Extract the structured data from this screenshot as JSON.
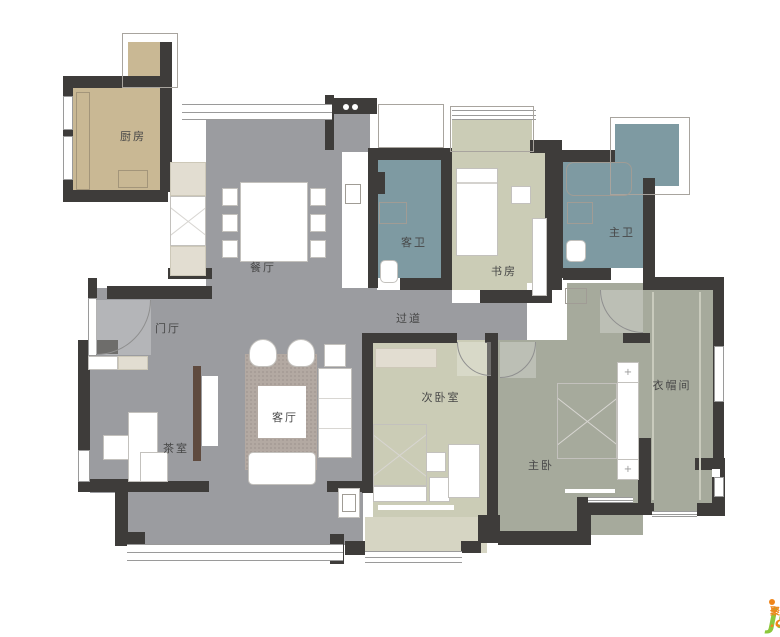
{
  "palette": {
    "wall": "#3e3c3a",
    "floor_gray": "#9b9ca0",
    "kitchen_tan": "#c9b894",
    "bath_teal": "#7e9aa2",
    "bedroom_sage": "#cbccb6",
    "master_green": "#a6aa9c",
    "balcony_sage": "#d6d5c3",
    "label": "#474747",
    "watermark_green": "#8cc83c",
    "watermark_orange": "#f08519"
  },
  "rooms": [
    {
      "id": "kitchen",
      "label": "厨房",
      "x": 133,
      "y": 136
    },
    {
      "id": "dining-room",
      "label": "餐厅",
      "x": 263,
      "y": 267
    },
    {
      "id": "guest-bathroom",
      "label": "客卫",
      "x": 414,
      "y": 242
    },
    {
      "id": "study",
      "label": "书房",
      "x": 504,
      "y": 271
    },
    {
      "id": "master-bathroom",
      "label": "主卫",
      "x": 622,
      "y": 232
    },
    {
      "id": "hallway",
      "label": "过道",
      "x": 409,
      "y": 318
    },
    {
      "id": "entrance-hall",
      "label": "门厅",
      "x": 168,
      "y": 328
    },
    {
      "id": "living-room",
      "label": "客厅",
      "x": 285,
      "y": 417
    },
    {
      "id": "tea-room",
      "label": "茶室",
      "x": 176,
      "y": 448
    },
    {
      "id": "second-bedroom",
      "label": "次卧室",
      "x": 441,
      "y": 397
    },
    {
      "id": "master-bedroom",
      "label": "主卧",
      "x": 541,
      "y": 465
    },
    {
      "id": "walk-in-closet",
      "label": "衣帽间",
      "x": 672,
      "y": 385
    }
  ],
  "floors": [
    {
      "name": "kitchen-floor",
      "x": 72,
      "y": 86,
      "w": 88,
      "h": 106,
      "color": "kitchen_tan"
    },
    {
      "name": "kitchen-neck-floor",
      "x": 128,
      "y": 42,
      "w": 34,
      "h": 46,
      "color": "kitchen_tan"
    },
    {
      "name": "dining-floor",
      "x": 206,
      "y": 112,
      "w": 136,
      "h": 176,
      "color": "floor_gray"
    },
    {
      "name": "hallway-floor",
      "x": 96,
      "y": 288,
      "w": 431,
      "h": 52,
      "color": "floor_gray"
    },
    {
      "name": "living-tea-floor",
      "x": 90,
      "y": 288,
      "w": 273,
      "h": 205,
      "color": "floor_gray"
    },
    {
      "name": "living-balcony-floor",
      "x": 127,
      "y": 493,
      "w": 236,
      "h": 52,
      "color": "floor_gray"
    },
    {
      "name": "heater-alcove-floor",
      "x": 334,
      "y": 112,
      "w": 36,
      "h": 42,
      "color": "floor_gray"
    },
    {
      "name": "guest-bath-floor",
      "x": 377,
      "y": 160,
      "w": 64,
      "h": 126,
      "color": "bath_teal"
    },
    {
      "name": "study-bay-floor",
      "x": 452,
      "y": 120,
      "w": 80,
      "h": 34,
      "color": "bedroom_sage"
    },
    {
      "name": "study-floor",
      "x": 452,
      "y": 152,
      "w": 93,
      "h": 150,
      "color": "bedroom_sage"
    },
    {
      "name": "master-bath-floor",
      "x": 563,
      "y": 162,
      "w": 80,
      "h": 106,
      "color": "bath_teal"
    },
    {
      "name": "master-bath-balcony",
      "x": 615,
      "y": 124,
      "w": 64,
      "h": 62,
      "color": "bath_teal"
    },
    {
      "name": "suite-entry-floor",
      "x": 567,
      "y": 283,
      "w": 76,
      "h": 57,
      "color": "master_green"
    },
    {
      "name": "master-bedroom-floor",
      "x": 498,
      "y": 340,
      "w": 145,
      "h": 195,
      "color": "master_green"
    },
    {
      "name": "closet-floor",
      "x": 643,
      "y": 290,
      "w": 70,
      "h": 223,
      "color": "master_green"
    },
    {
      "name": "second-bedroom-floor",
      "x": 373,
      "y": 340,
      "w": 114,
      "h": 177,
      "color": "bedroom_sage"
    },
    {
      "name": "second-balcony-floor",
      "x": 365,
      "y": 517,
      "w": 122,
      "h": 36,
      "color": "balcony_sage"
    }
  ],
  "white_patches": [
    [
      342,
      152,
      26,
      133
    ],
    [
      527,
      283,
      40,
      57
    ],
    [
      452,
      290,
      28,
      13
    ],
    [
      377,
      278,
      23,
      12
    ],
    [
      611,
      268,
      32,
      12
    ]
  ],
  "walls": [
    [
      63,
      76,
      100,
      12
    ],
    [
      63,
      88,
      10,
      104
    ],
    [
      63,
      190,
      105,
      12
    ],
    [
      160,
      42,
      12,
      150
    ],
    [
      107,
      286,
      105,
      13
    ],
    [
      88,
      278,
      9,
      22
    ],
    [
      78,
      340,
      40,
      14
    ],
    [
      78,
      340,
      12,
      152
    ],
    [
      78,
      479,
      50,
      13
    ],
    [
      115,
      487,
      13,
      52
    ],
    [
      115,
      532,
      30,
      14
    ],
    [
      127,
      481,
      82,
      11
    ],
    [
      327,
      481,
      37,
      11
    ],
    [
      330,
      534,
      14,
      30
    ],
    [
      362,
      333,
      11,
      160
    ],
    [
      345,
      541,
      20,
      14
    ],
    [
      478,
      515,
      22,
      28
    ],
    [
      461,
      541,
      20,
      12
    ],
    [
      325,
      95,
      9,
      55
    ],
    [
      331,
      98,
      46,
      16
    ],
    [
      368,
      148,
      80,
      12
    ],
    [
      368,
      155,
      10,
      133
    ],
    [
      441,
      148,
      11,
      142
    ],
    [
      400,
      278,
      52,
      12
    ],
    [
      480,
      290,
      72,
      13
    ],
    [
      530,
      140,
      32,
      13
    ],
    [
      545,
      148,
      17,
      142
    ],
    [
      553,
      150,
      62,
      12
    ],
    [
      553,
      152,
      10,
      126
    ],
    [
      563,
      268,
      48,
      12
    ],
    [
      643,
      178,
      12,
      104
    ],
    [
      643,
      277,
      81,
      13
    ],
    [
      713,
      283,
      11,
      175
    ],
    [
      695,
      458,
      30,
      12
    ],
    [
      712,
      470,
      13,
      40
    ],
    [
      697,
      503,
      28,
      13
    ],
    [
      638,
      438,
      13,
      75
    ],
    [
      623,
      333,
      27,
      10
    ],
    [
      362,
      333,
      95,
      10
    ],
    [
      485,
      333,
      13,
      10
    ],
    [
      487,
      333,
      11,
      202
    ],
    [
      498,
      531,
      86,
      14
    ],
    [
      577,
      497,
      14,
      48
    ],
    [
      577,
      503,
      77,
      12
    ],
    [
      168,
      268,
      44,
      11
    ]
  ],
  "windows": {
    "bands": [
      [
        182,
        104,
        150,
        16
      ],
      [
        127,
        544,
        216,
        17
      ],
      [
        365,
        551,
        97,
        12
      ],
      [
        452,
        110,
        84,
        10
      ],
      [
        588,
        497,
        45,
        6
      ],
      [
        652,
        511,
        45,
        6
      ]
    ],
    "plains": [
      [
        63,
        96,
        10,
        34
      ],
      [
        63,
        136,
        10,
        44
      ],
      [
        88,
        298,
        9,
        58
      ],
      [
        78,
        450,
        12,
        32
      ],
      [
        714,
        346,
        10,
        56
      ],
      [
        714,
        477,
        10,
        20
      ]
    ]
  },
  "outlines": [
    [
      122,
      33,
      56,
      55
    ],
    [
      610,
      117,
      80,
      78
    ],
    [
      378,
      104,
      66,
      44
    ],
    [
      450,
      106,
      84,
      46
    ]
  ],
  "furniture": [
    {
      "name": "kitchen-counter",
      "type": "outline-tan",
      "x": 76,
      "y": 92,
      "w": 14,
      "h": 98
    },
    {
      "name": "kitchen-stove",
      "type": "outline-tan",
      "x": 118,
      "y": 170,
      "w": 30,
      "h": 18
    },
    {
      "name": "pantry-cabinet",
      "type": "white",
      "x": 170,
      "y": 162,
      "w": 36,
      "h": 114
    },
    {
      "name": "pantry-shelf-top",
      "type": "beige",
      "x": 170,
      "y": 162,
      "w": 36,
      "h": 34
    },
    {
      "name": "pantry-shelf-bottom",
      "type": "beige",
      "x": 170,
      "y": 246,
      "w": 36,
      "h": 30
    },
    {
      "name": "pantry-x-cabinet",
      "type": "diag",
      "x": 170,
      "y": 196,
      "w": 36,
      "h": 50
    },
    {
      "name": "heater-dot",
      "type": "dot",
      "x": 343,
      "y": 104,
      "w": 6,
      "h": 6
    },
    {
      "name": "heater-dot",
      "type": "dot",
      "x": 352,
      "y": 104,
      "w": 6,
      "h": 6
    },
    {
      "name": "laundry-unit",
      "type": "outline",
      "x": 345,
      "y": 184,
      "w": 16,
      "h": 20
    },
    {
      "name": "dining-table",
      "type": "white",
      "x": 240,
      "y": 182,
      "w": 68,
      "h": 80
    },
    {
      "name": "dining-chair",
      "type": "white",
      "x": 222,
      "y": 188,
      "w": 16,
      "h": 18
    },
    {
      "name": "dining-chair",
      "type": "white",
      "x": 222,
      "y": 214,
      "w": 16,
      "h": 18
    },
    {
      "name": "dining-chair",
      "type": "white",
      "x": 222,
      "y": 240,
      "w": 16,
      "h": 18
    },
    {
      "name": "dining-chair",
      "type": "white",
      "x": 310,
      "y": 188,
      "w": 16,
      "h": 18
    },
    {
      "name": "dining-chair",
      "type": "white",
      "x": 310,
      "y": 214,
      "w": 16,
      "h": 18
    },
    {
      "name": "dining-chair",
      "type": "white",
      "x": 310,
      "y": 240,
      "w": 16,
      "h": 18
    },
    {
      "name": "entry-cabinet",
      "type": "white",
      "x": 88,
      "y": 356,
      "w": 30,
      "h": 14
    },
    {
      "name": "entry-cabinet",
      "type": "beige",
      "x": 118,
      "y": 356,
      "w": 30,
      "h": 14
    },
    {
      "name": "tea-desk",
      "type": "white",
      "x": 128,
      "y": 412,
      "w": 30,
      "h": 70
    },
    {
      "name": "tea-chair",
      "type": "white",
      "x": 103,
      "y": 435,
      "w": 26,
      "h": 25
    },
    {
      "name": "tea-cabinet",
      "type": "white",
      "x": 140,
      "y": 452,
      "w": 28,
      "h": 30
    },
    {
      "name": "tv-shelf",
      "type": "brown",
      "x": 193,
      "y": 366,
      "w": 8,
      "h": 95
    },
    {
      "name": "tv-panel",
      "type": "whiteplain",
      "x": 202,
      "y": 376,
      "w": 16,
      "h": 70
    },
    {
      "name": "living-rug",
      "type": "rug",
      "x": 245,
      "y": 354,
      "w": 72,
      "h": 116
    },
    {
      "name": "armchair",
      "type": "round",
      "x": 249,
      "y": 339,
      "w": 28,
      "h": 28
    },
    {
      "name": "armchair",
      "type": "round",
      "x": 287,
      "y": 339,
      "w": 28,
      "h": 28
    },
    {
      "name": "side-table",
      "type": "white",
      "x": 324,
      "y": 344,
      "w": 22,
      "h": 23
    },
    {
      "name": "sofa",
      "type": "lines",
      "x": 318,
      "y": 368,
      "w": 34,
      "h": 90
    },
    {
      "name": "coffee-table",
      "type": "whiteplain",
      "x": 258,
      "y": 386,
      "w": 48,
      "h": 52
    },
    {
      "name": "sofa-bench",
      "type": "rounded",
      "x": 248,
      "y": 452,
      "w": 68,
      "h": 33
    },
    {
      "name": "balcony-basin",
      "type": "white",
      "x": 338,
      "y": 488,
      "w": 22,
      "h": 30
    },
    {
      "name": "balcony-basin-bowl",
      "type": "outline",
      "x": 342,
      "y": 494,
      "w": 14,
      "h": 18
    },
    {
      "name": "guest-bath-shelf",
      "type": "dark",
      "x": 377,
      "y": 172,
      "w": 8,
      "h": 22
    },
    {
      "name": "guest-washbasin",
      "type": "outline",
      "x": 379,
      "y": 202,
      "w": 28,
      "h": 22
    },
    {
      "name": "guest-toilet",
      "type": "rounded",
      "x": 380,
      "y": 260,
      "w": 18,
      "h": 23
    },
    {
      "name": "study-bed",
      "type": "white",
      "x": 456,
      "y": 168,
      "w": 42,
      "h": 88
    },
    {
      "name": "study-bed-pillow-line",
      "type": "divider",
      "x": 457,
      "y": 182,
      "w": 40,
      "h": 2
    },
    {
      "name": "study-desk",
      "type": "white",
      "x": 511,
      "y": 186,
      "w": 20,
      "h": 18
    },
    {
      "name": "study-cabinet",
      "type": "white",
      "x": 532,
      "y": 218,
      "w": 15,
      "h": 78
    },
    {
      "name": "master-bathtub",
      "type": "outline-round",
      "x": 566,
      "y": 162,
      "w": 66,
      "h": 34
    },
    {
      "name": "master-washbasin",
      "type": "outline",
      "x": 567,
      "y": 202,
      "w": 26,
      "h": 22
    },
    {
      "name": "master-toilet",
      "type": "rounded",
      "x": 566,
      "y": 240,
      "w": 20,
      "h": 22
    },
    {
      "name": "suite-shoe-cabinet",
      "type": "outline",
      "x": 565,
      "y": 288,
      "w": 22,
      "h": 16
    },
    {
      "name": "bedroom2-wardrobe",
      "type": "beige",
      "x": 375,
      "y": 348,
      "w": 62,
      "h": 20
    },
    {
      "name": "bedroom2-bed",
      "type": "diag",
      "x": 373,
      "y": 424,
      "w": 54,
      "h": 62
    },
    {
      "name": "bedroom2-pillow",
      "type": "white",
      "x": 373,
      "y": 486,
      "w": 54,
      "h": 16
    },
    {
      "name": "bedroom2-nightstand",
      "type": "white",
      "x": 429,
      "y": 477,
      "w": 21,
      "h": 25
    },
    {
      "name": "bedroom2-desk",
      "type": "white",
      "x": 448,
      "y": 444,
      "w": 32,
      "h": 54
    },
    {
      "name": "bedroom2-chair",
      "type": "white",
      "x": 426,
      "y": 452,
      "w": 20,
      "h": 20
    },
    {
      "name": "bedroom2-window-sill",
      "type": "whiteplain",
      "x": 378,
      "y": 505,
      "w": 76,
      "h": 5
    },
    {
      "name": "master-bed",
      "type": "diag",
      "x": 557,
      "y": 383,
      "w": 60,
      "h": 76
    },
    {
      "name": "master-headboard",
      "type": "white",
      "x": 617,
      "y": 362,
      "w": 22,
      "h": 118
    },
    {
      "name": "master-nightstand",
      "type": "plus",
      "x": 617,
      "y": 362,
      "w": 22,
      "h": 21
    },
    {
      "name": "master-nightstand",
      "type": "plus",
      "x": 617,
      "y": 459,
      "w": 22,
      "h": 21
    },
    {
      "name": "master-bench",
      "type": "whiteplain",
      "x": 565,
      "y": 489,
      "w": 50,
      "h": 4
    },
    {
      "name": "closet-shelf-line",
      "type": "lightline",
      "x": 652,
      "y": 292,
      "w": 2,
      "h": 208
    },
    {
      "name": "closet-shelf-line",
      "type": "lightline",
      "x": 699,
      "y": 292,
      "w": 2,
      "h": 208
    },
    {
      "name": "closet-fixture",
      "type": "whiteplain",
      "x": 712,
      "y": 469,
      "w": 8,
      "h": 8
    }
  ],
  "arcs": [
    {
      "name": "entry-door-arc",
      "quadrant": "tl",
      "x": 96,
      "y": 300,
      "r": 55
    },
    {
      "name": "master-door-arc",
      "quadrant": "tl",
      "x": 500,
      "y": 342,
      "r": 36
    },
    {
      "name": "second-bedroom-door-arc",
      "quadrant": "tr",
      "x": 457,
      "y": 342,
      "r": 34
    },
    {
      "name": "closet-door-arc",
      "quadrant": "tr",
      "x": 600,
      "y": 290,
      "r": 43
    }
  ],
  "watermark": {
    "brand": "jsheh",
    "tld": ".com",
    "cn": "聚设汇"
  }
}
